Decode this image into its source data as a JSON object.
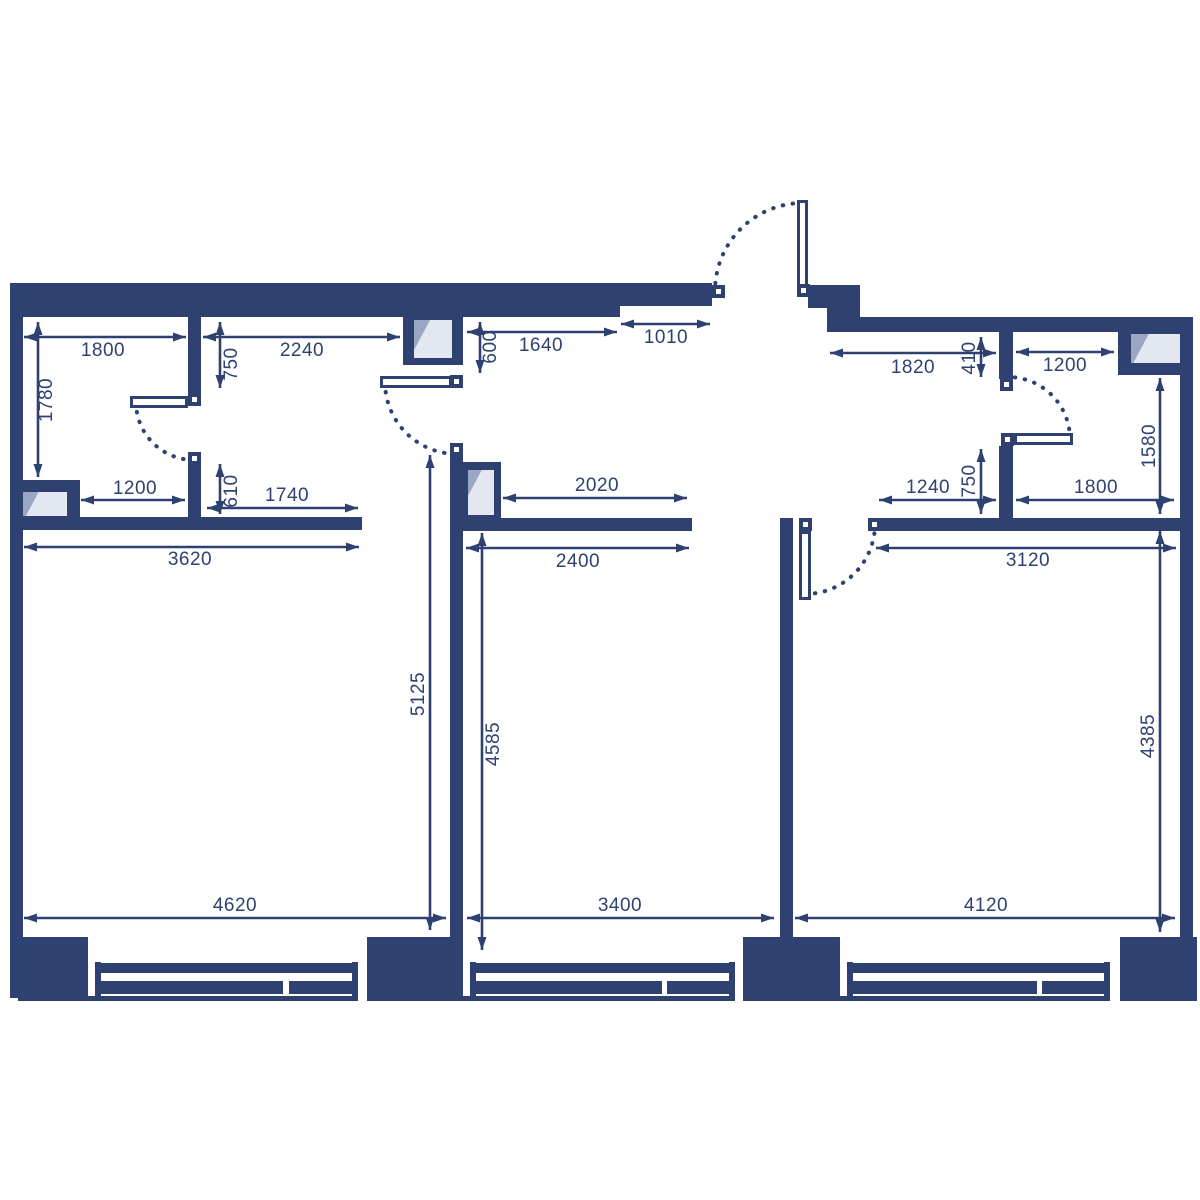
{
  "colors": {
    "bg": "#ffffff",
    "wall": "#2E4170",
    "vent_light": "#E3E7EF",
    "vent_shade": "#9AA6C2",
    "leaf_fill": "#ffffff"
  },
  "plan": {
    "walls": [
      [
        10,
        283,
        13,
        715
      ],
      [
        10,
        283,
        610,
        34
      ],
      [
        620,
        283,
        92,
        23
      ],
      [
        808,
        285,
        52,
        23
      ],
      [
        827,
        306,
        33,
        26
      ],
      [
        860,
        317,
        332,
        15
      ],
      [
        1180,
        317,
        13,
        681
      ],
      [
        188,
        313,
        13,
        85
      ],
      [
        188,
        452,
        13,
        78
      ],
      [
        22,
        517,
        340,
        13
      ],
      [
        450,
        443,
        13,
        494
      ],
      [
        463,
        518,
        229,
        13
      ],
      [
        780,
        518,
        13,
        419
      ],
      [
        868,
        518,
        324,
        13
      ],
      [
        999,
        332,
        14,
        47
      ],
      [
        999,
        446,
        14,
        84
      ],
      [
        18,
        937,
        70,
        64
      ],
      [
        367,
        937,
        96,
        64
      ],
      [
        743,
        937,
        97,
        64
      ],
      [
        1120,
        937,
        77,
        64
      ]
    ],
    "window_frames": [
      [
        95,
        962,
        6,
        36
      ],
      [
        352,
        962,
        6,
        36
      ],
      [
        101,
        963,
        251,
        10
      ],
      [
        101,
        981,
        182,
        13
      ],
      [
        289,
        981,
        63,
        13
      ],
      [
        88,
        996,
        270,
        5
      ],
      [
        470,
        962,
        6,
        36
      ],
      [
        729,
        962,
        6,
        36
      ],
      [
        476,
        963,
        253,
        10
      ],
      [
        476,
        981,
        186,
        13
      ],
      [
        667,
        981,
        62,
        13
      ],
      [
        463,
        996,
        272,
        5
      ],
      [
        847,
        962,
        6,
        36
      ],
      [
        1104,
        962,
        6,
        36
      ],
      [
        853,
        963,
        251,
        10
      ],
      [
        853,
        981,
        184,
        13
      ],
      [
        1042,
        981,
        62,
        13
      ],
      [
        840,
        996,
        270,
        5
      ]
    ],
    "vents": [
      {
        "block": [
          18,
          480,
          62,
          38
        ],
        "pane": [
          23,
          492,
          44,
          24
        ]
      },
      {
        "block": [
          403,
          313,
          60,
          52
        ],
        "pane": [
          414,
          320,
          38,
          38
        ]
      },
      {
        "block": [
          463,
          462,
          38,
          58
        ],
        "pane": [
          468,
          470,
          26,
          45
        ]
      },
      {
        "block": [
          1118,
          317,
          74,
          58
        ],
        "pane": [
          1131,
          334,
          49,
          29
        ]
      }
    ],
    "door_leaves": [
      [
        130,
        396,
        58,
        12
      ],
      [
        380,
        376,
        72,
        12
      ],
      [
        797,
        200,
        11,
        92
      ],
      [
        1014,
        433,
        59,
        12
      ],
      [
        799,
        531,
        12,
        69
      ]
    ],
    "door_jambs": [
      [
        188,
        393
      ],
      [
        188,
        452
      ],
      [
        450,
        375
      ],
      [
        450,
        443
      ],
      [
        712,
        285
      ],
      [
        797,
        284
      ],
      [
        1000,
        378
      ],
      [
        1001,
        433
      ],
      [
        799,
        518
      ],
      [
        868,
        518
      ]
    ],
    "door_arcs": [
      {
        "d": "M136,402 A58,58 0 0 0 194,460"
      },
      {
        "d": "M385,382 A72,72 0 0 0 457,454"
      },
      {
        "d": "M803,203 A88,88 0 0 0 715,291"
      },
      {
        "d": "M1070,439 A62,62 0 0 0 1008,377"
      },
      {
        "d": "M805,594 A70,70 0 0 0 875,524"
      }
    ]
  },
  "dimensions": {
    "horizontal": [
      {
        "label": "1800",
        "y": 337,
        "x1": 24,
        "x2": 186,
        "lx": 103,
        "ly": 351
      },
      {
        "label": "2240",
        "y": 337,
        "x1": 203,
        "x2": 400,
        "lx": 302,
        "ly": 351
      },
      {
        "label": "1640",
        "y": 332,
        "x1": 467,
        "x2": 617,
        "lx": 541,
        "ly": 346
      },
      {
        "label": "1010",
        "y": 324,
        "x1": 621,
        "x2": 710,
        "lx": 666,
        "ly": 338
      },
      {
        "label": "1820",
        "y": 353,
        "x1": 830,
        "x2": 996,
        "lx": 913,
        "ly": 368
      },
      {
        "label": "1200",
        "y": 352,
        "x1": 1016,
        "x2": 1114,
        "lx": 1065,
        "ly": 366
      },
      {
        "label": "1200",
        "y": 500,
        "x1": 81,
        "x2": 185,
        "lx": 135,
        "ly": 489
      },
      {
        "label": "1740",
        "y": 508,
        "x1": 207,
        "x2": 358,
        "lx": 287,
        "ly": 496
      },
      {
        "label": "2020",
        "y": 498,
        "x1": 503,
        "x2": 687,
        "lx": 597,
        "ly": 486
      },
      {
        "label": "1240",
        "y": 500,
        "x1": 879,
        "x2": 996,
        "lx": 928,
        "ly": 488
      },
      {
        "label": "1800",
        "y": 500,
        "x1": 1016,
        "x2": 1174,
        "lx": 1096,
        "ly": 488
      },
      {
        "label": "3620",
        "y": 547,
        "x1": 24,
        "x2": 359,
        "lx": 190,
        "ly": 560
      },
      {
        "label": "2400",
        "y": 548,
        "x1": 466,
        "x2": 689,
        "lx": 578,
        "ly": 562
      },
      {
        "label": "3120",
        "y": 548,
        "x1": 876,
        "x2": 1176,
        "lx": 1028,
        "ly": 561
      },
      {
        "label": "4620",
        "y": 918,
        "x1": 24,
        "x2": 446,
        "lx": 235,
        "ly": 906
      },
      {
        "label": "3400",
        "y": 918,
        "x1": 467,
        "x2": 774,
        "lx": 620,
        "ly": 906
      },
      {
        "label": "4120",
        "y": 918,
        "x1": 795,
        "x2": 1175,
        "lx": 986,
        "ly": 906
      }
    ],
    "vertical": [
      {
        "label": "1780",
        "x": 38,
        "y1": 322,
        "y2": 477,
        "lx": 47,
        "ly": 400
      },
      {
        "label": "750",
        "x": 220,
        "y1": 322,
        "y2": 388,
        "lx": 232,
        "ly": 364
      },
      {
        "label": "600",
        "x": 480,
        "y1": 322,
        "y2": 373,
        "lx": 491,
        "ly": 347
      },
      {
        "label": "410",
        "x": 981,
        "y1": 337,
        "y2": 377,
        "lx": 970,
        "ly": 358
      },
      {
        "label": "1580",
        "x": 1160,
        "y1": 378,
        "y2": 514,
        "lx": 1150,
        "ly": 446
      },
      {
        "label": "610",
        "x": 220,
        "y1": 464,
        "y2": 514,
        "lx": 232,
        "ly": 491
      },
      {
        "label": "750",
        "x": 981,
        "y1": 449,
        "y2": 514,
        "lx": 970,
        "ly": 481
      },
      {
        "label": "5125",
        "x": 430,
        "y1": 455,
        "y2": 930,
        "lx": 419,
        "ly": 694
      },
      {
        "label": "4585",
        "x": 482,
        "y1": 533,
        "y2": 950,
        "lx": 494,
        "ly": 744
      },
      {
        "label": "4385",
        "x": 1160,
        "y1": 531,
        "y2": 932,
        "lx": 1149,
        "ly": 736
      }
    ]
  }
}
